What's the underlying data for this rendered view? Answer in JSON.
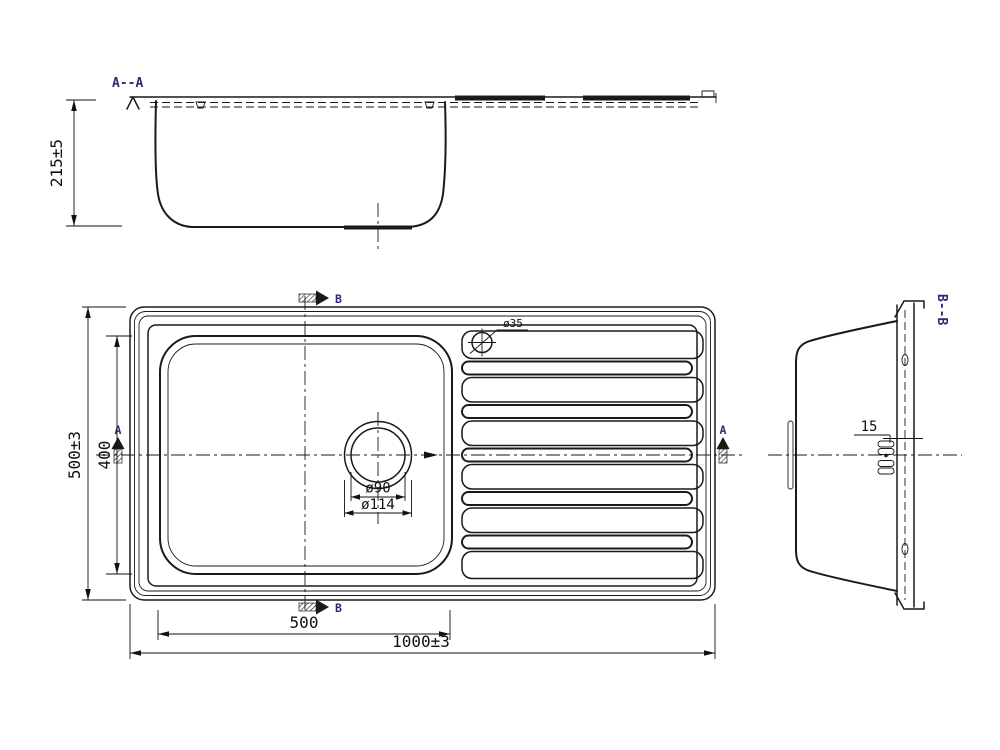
{
  "drawing": {
    "section_aa_title": "A--A",
    "section_bb_title": "B--B",
    "marker_a": "A",
    "marker_b": "B"
  },
  "dimensions": {
    "overall_depth": "215±5",
    "overall_length": "1000±3",
    "overall_width": "500±3",
    "bowl_length": "500",
    "bowl_width": "400",
    "tap_hole": "ø35",
    "drain_inner": "ø90",
    "drain_outer": "ø114",
    "rim_flange": "15"
  },
  "colors": {
    "background": "#ffffff",
    "ink": "#1a1a1a",
    "section_label": "#2b2b7a"
  }
}
